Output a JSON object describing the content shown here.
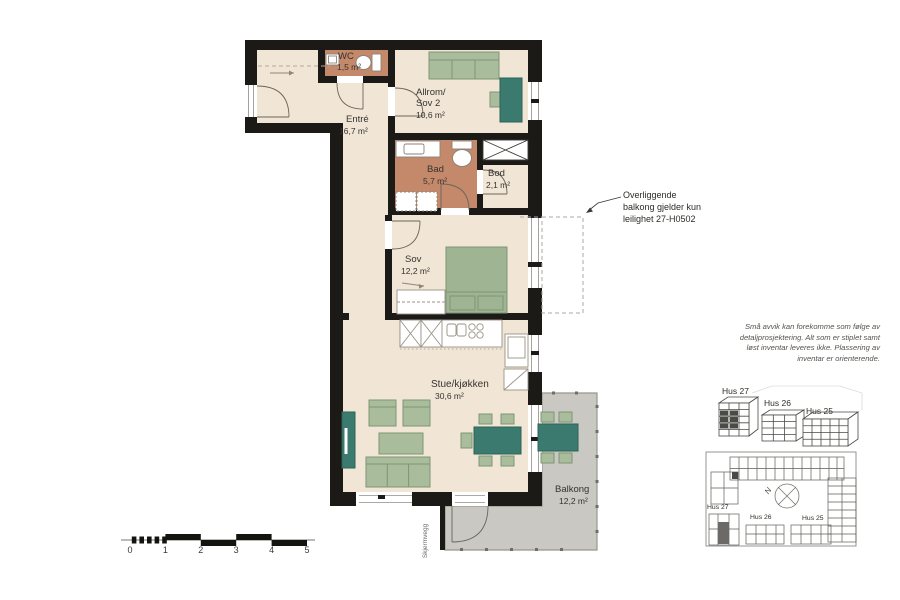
{
  "plan_title": "Leilighetsplan 27-H0502",
  "rooms": {
    "wc": {
      "name": "WC",
      "area": "1,5 m²"
    },
    "allrom": {
      "name_line1": "Allrom/",
      "name_line2": "Sov 2",
      "area": "10,6 m²"
    },
    "entre": {
      "name": "Entré",
      "area": "16,7 m²"
    },
    "bad": {
      "name": "Bad",
      "area": "5,7 m²"
    },
    "bod": {
      "name": "Bod",
      "area": "2,1 m²"
    },
    "sov": {
      "name": "Sov",
      "area": "12,2 m²"
    },
    "stue": {
      "name": "Stue/kjøkken",
      "area": "30,6 m²"
    },
    "balkong": {
      "name": "Balkong",
      "area": "12,2 m²"
    }
  },
  "features": {
    "skjermvegg": "Skjermvegg"
  },
  "annotation": {
    "lines": [
      "Overliggende",
      "balkong gjelder kun",
      "leilighet 27-H0502"
    ]
  },
  "disclaimer": {
    "lines": [
      "Små avvik kan forekomme som følge av",
      "detaljprosjektering. Alt som er stiplet samt",
      "løst inventar leveres ikke. Plassering av",
      "inventar er orienterende."
    ]
  },
  "elevations": {
    "hus27": "Hus 27",
    "hus26": "Hus 26",
    "hus25": "Hus 25"
  },
  "siteplan": {
    "hus27": "Hus 27",
    "hus26": "Hus 26",
    "hus25": "Hus 25",
    "north": "N"
  },
  "scalebar": {
    "unit_labels": [
      "0",
      "1",
      "2",
      "3",
      "4",
      "5"
    ]
  },
  "colors": {
    "wall": "#1b1a17",
    "floor": "#f1e6d6",
    "wet_room_floor": "#c4886b",
    "furniture_green": "#a9bc9b",
    "furniture_teal": "#3b7a6e",
    "balcony_grey": "#c9c8c3"
  }
}
